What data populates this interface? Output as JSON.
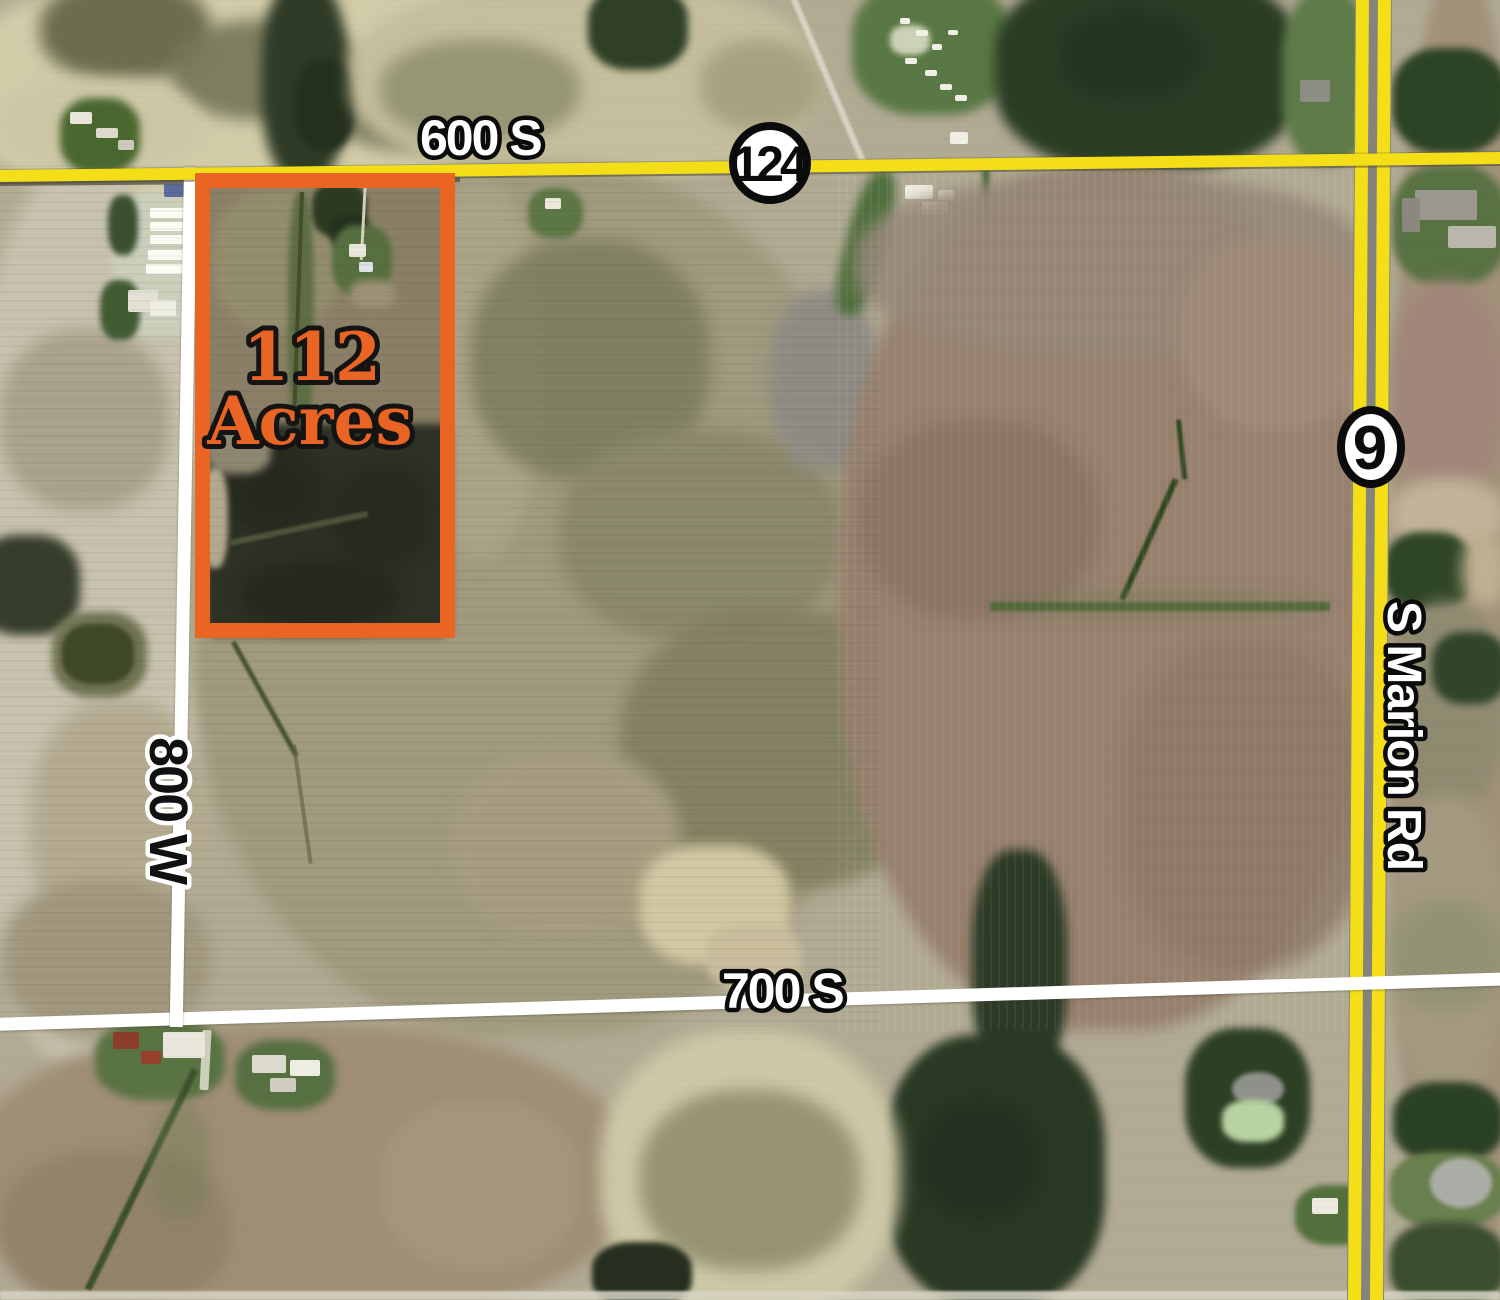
{
  "annotations": {
    "parcel": {
      "acreage": "112",
      "acreage_unit": "Acres"
    },
    "road_labels": {
      "road_600s": "600 S",
      "road_700s": "700 S",
      "road_800w": "800 W",
      "s_marion_rd": "S Marion Rd"
    },
    "route_shields": {
      "route_124": "124",
      "route_9": "9"
    }
  },
  "colors": {
    "parcel_outline": "#ea6424",
    "parcel_label": "#ea6424",
    "state_highway_overlay": "#f4de18",
    "county_road_overlay": "#ffffff",
    "shield_fill": "#ffffff",
    "shield_outline": "#0b0b0b",
    "label_fill": "#ffffff",
    "label_outline": "#0b0b0b"
  }
}
